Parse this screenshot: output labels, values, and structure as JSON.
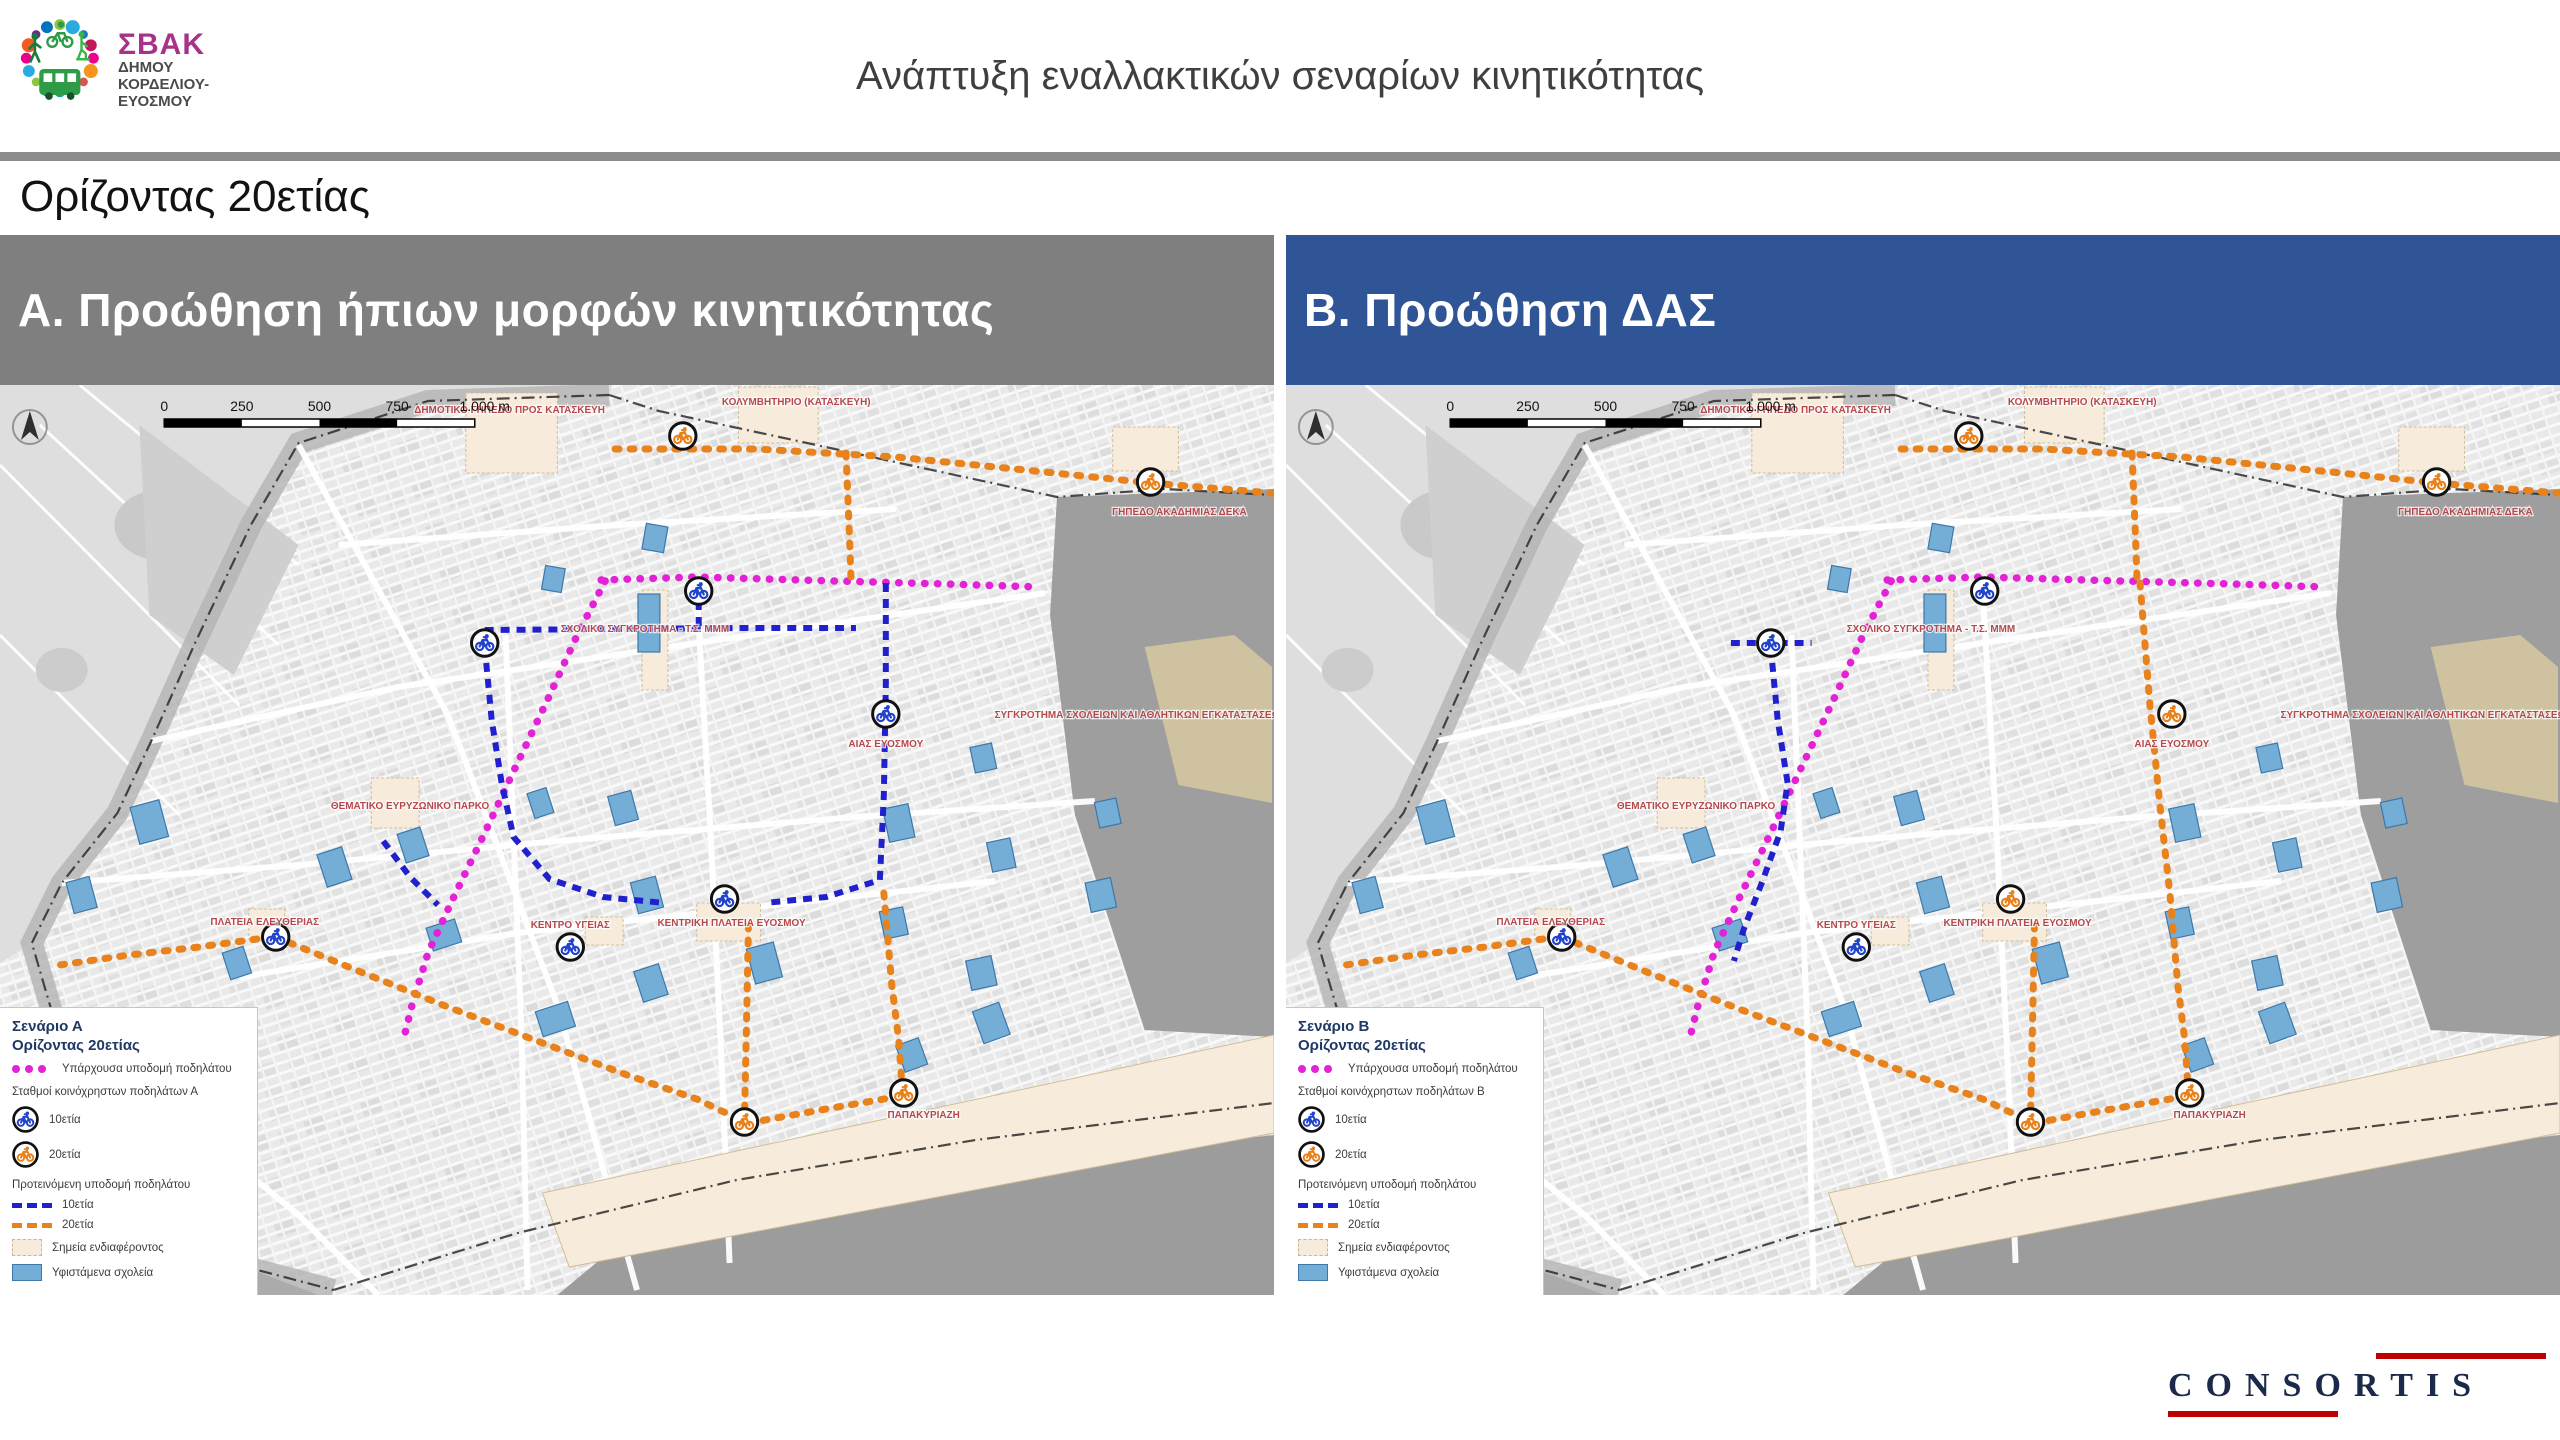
{
  "header": {
    "logo": {
      "abbr": "ΣΒΑΚ",
      "abbr_color": "#a83288",
      "line1": "ΔΗΜΟΥ",
      "line2": "ΚΟΡΔΕΛΙΟΥ-",
      "line3": "ΕΥΟΣΜΟΥ",
      "dot_colors": [
        "#8cc63f",
        "#29abe2",
        "#1b75bc",
        "#c2185b",
        "#ec008c",
        "#f7941d",
        "#d9534f",
        "#39b54a",
        "#00a99d",
        "#9e005d",
        "#8cc63f",
        "#29abe2",
        "#ec008c",
        "#f15a24",
        "#662d91",
        "#0071bc"
      ]
    },
    "title": "Ανάπτυξη εναλλακτικών σεναρίων κινητικότητας"
  },
  "subtitle": "Ορίζοντας 20ετίας",
  "footer": {
    "brand": "CONSORTIS",
    "accent": "#c00000"
  },
  "colors": {
    "panel_a_header": "#7f7f7f",
    "panel_b_header": "#2f5597",
    "existing": "#e322d6",
    "proposed10": "#2020cc",
    "proposed20": "#e8821c",
    "station10": "#2244cc",
    "station20": "#e8821c",
    "map_label": "#b5484d",
    "legend_title": "#1f3864",
    "poi_fill": "#f7ecdc",
    "school_fill": "#74add6",
    "school_stroke": "#3c78aa",
    "map_bg": "#e9e9e9",
    "outside_dark": "#9e9e9e"
  },
  "base_map": {
    "scale_labels": [
      "0",
      "250",
      "500",
      "750",
      "1.000 m"
    ],
    "labels": [
      {
        "t": "ΔΗΜΟΤΙΚΟ ΓΗΠΕΔΟ ΠΡΟΣ ΚΑΤΑΣΚΕΥΗ",
        "x": 512,
        "y": 28
      },
      {
        "t": "ΚΟΛΥΜΒΗΤΗΡΙΟ (ΚΑΤΑΣΚΕΥΗ)",
        "x": 800,
        "y": 20
      },
      {
        "t": "ΓΗΠΕΔΟ ΑΚΑΔΗΜΙΑΣ ΔΕΚΑ",
        "x": 1185,
        "y": 130
      },
      {
        "t": "ΣΧΟΛΙΚΟ ΣΥΓΚΡΟΤΗΜΑ - Τ.Σ. ΜΜΜ",
        "x": 648,
        "y": 247
      },
      {
        "t": "ΣΥΓΚΡΟΤΗΜΑ ΣΧΟΛΕΙΩΝ ΚΑΙ ΑΘΛΗΤΙΚΩΝ ΕΓΚΑΤΑΣΤΑΣΕΩΝ",
        "x": 1146,
        "y": 333
      },
      {
        "t": "ΑΙΑΣ ΕΥΟΣΜΟΥ",
        "x": 890,
        "y": 362
      },
      {
        "t": "ΘΕΜΑΤΙΚΟ ΕΥΡΥΖΩΝΙΚΟ ΠΑΡΚΟ",
        "x": 412,
        "y": 424
      },
      {
        "t": "ΠΛΑΤΕΙΑ ΕΛΕΥΘΕΡΙΑΣ",
        "x": 266,
        "y": 540
      },
      {
        "t": "ΚΕΝΤΡΟ ΥΓΕΙΑΣ",
        "x": 573,
        "y": 543
      },
      {
        "t": "ΚΕΝΤΡΙΚΗ ΠΛΑΤΕΙΑ ΕΥΟΣΜΟΥ",
        "x": 735,
        "y": 541
      },
      {
        "t": "ΠΑΠΑΚΥΡΙΑΖΗ",
        "x": 928,
        "y": 733
      }
    ],
    "pois": [
      [
        468,
        8,
        92,
        80
      ],
      [
        742,
        2,
        80,
        56
      ],
      [
        645,
        205,
        26,
        100
      ],
      [
        700,
        518,
        64,
        38
      ],
      [
        373,
        393,
        48,
        50
      ],
      [
        250,
        524,
        36,
        30
      ],
      [
        588,
        532,
        38,
        28
      ],
      [
        1118,
        42,
        66,
        44
      ]
    ],
    "poi_band": "545,808 1280,650 1280,748 572,882",
    "schools": [
      [
        150,
        437,
        30,
        38,
        -15
      ],
      [
        82,
        510,
        24,
        32,
        -15
      ],
      [
        336,
        482,
        26,
        34,
        -18
      ],
      [
        238,
        578,
        22,
        28,
        -18
      ],
      [
        415,
        460,
        24,
        30,
        -18
      ],
      [
        446,
        550,
        30,
        24,
        -18
      ],
      [
        558,
        634,
        34,
        26,
        -18
      ],
      [
        654,
        598,
        26,
        32,
        -18
      ],
      [
        768,
        578,
        28,
        36,
        -15
      ],
      [
        650,
        510,
        26,
        32,
        -15
      ],
      [
        626,
        423,
        24,
        30,
        -15
      ],
      [
        903,
        438,
        26,
        34,
        -12
      ],
      [
        1006,
        470,
        24,
        30,
        -12
      ],
      [
        1106,
        510,
        26,
        30,
        -12
      ],
      [
        1113,
        428,
        22,
        26,
        -12
      ],
      [
        986,
        588,
        26,
        30,
        -12
      ],
      [
        898,
        538,
        24,
        28,
        -12
      ],
      [
        658,
        153,
        22,
        26,
        10
      ],
      [
        556,
        194,
        20,
        24,
        10
      ],
      [
        988,
        373,
        22,
        26,
        -12
      ],
      [
        543,
        418,
        20,
        26,
        -18
      ],
      [
        996,
        638,
        28,
        34,
        -20
      ],
      [
        916,
        670,
        24,
        28,
        -20
      ],
      [
        652,
        238,
        22,
        58,
        0
      ]
    ],
    "roads": [
      [
        [
          300,
          60
        ],
        [
          450,
          330
        ],
        [
          560,
          620
        ],
        [
          640,
          905
        ]
      ],
      [
        [
          0,
          636
        ],
        [
          140,
          700
        ],
        [
          300,
          830
        ],
        [
          380,
          910
        ]
      ],
      [
        [
          152,
          356
        ],
        [
          400,
          302
        ],
        [
          700,
          258
        ],
        [
          1050,
          208
        ]
      ],
      [
        [
          62,
          498
        ],
        [
          300,
          480
        ],
        [
          560,
          456
        ],
        [
          860,
          432
        ],
        [
          1100,
          416
        ]
      ],
      [
        [
          240,
          592
        ],
        [
          520,
          548
        ],
        [
          760,
          522
        ],
        [
          1000,
          496
        ]
      ],
      [
        [
          508,
          250
        ],
        [
          516,
          450
        ],
        [
          524,
          650
        ],
        [
          530,
          905
        ]
      ],
      [
        [
          700,
          205
        ],
        [
          714,
          450
        ],
        [
          726,
          700
        ],
        [
          733,
          878
        ]
      ],
      [
        [
          340,
          160
        ],
        [
          620,
          140
        ],
        [
          900,
          124
        ]
      ]
    ],
    "fields_region": "0,0 615,0 612,10 430,16 300,58 252,140 196,258 152,356 118,428 62,498 32,558 0,578",
    "field_lines": [
      [
        [
          0,
          80
        ],
        [
          240,
          320
        ]
      ],
      [
        [
          40,
          40
        ],
        [
          280,
          260
        ]
      ],
      [
        [
          0,
          250
        ],
        [
          180,
          430
        ]
      ],
      [
        [
          80,
          0
        ],
        [
          300,
          180
        ]
      ]
    ],
    "dark_regions": [
      {
        "points": "1062,112 1280,104 1280,652 1150,645 1080,430 1055,230",
        "fill": "#9e9e9e"
      },
      {
        "points": "560,910 640,844 900,792 1280,750 1280,910",
        "fill": "#9c9c9c"
      },
      {
        "points": "0,688 120,756 230,876 320,910 0,910",
        "fill": "#ababab"
      },
      {
        "points": "1150,262 1240,250 1278,282 1278,418 1184,400",
        "fill": "#cfc2a0"
      }
    ],
    "boundary_left": [
      [
        612,
        10
      ],
      [
        430,
        16
      ],
      [
        300,
        58
      ],
      [
        252,
        140
      ],
      [
        196,
        258
      ],
      [
        152,
        356
      ],
      [
        118,
        428
      ],
      [
        62,
        498
      ],
      [
        32,
        558
      ],
      [
        56,
        640
      ],
      [
        130,
        758
      ],
      [
        232,
        878
      ],
      [
        335,
        905
      ]
    ],
    "boundary_right": [
      [
        612,
        10
      ],
      [
        662,
        26
      ],
      [
        1062,
        112
      ],
      [
        1170,
        104
      ],
      [
        1278,
        110
      ]
    ],
    "boundary_bottom": [
      [
        335,
        905
      ],
      [
        520,
        848
      ],
      [
        740,
        795
      ],
      [
        980,
        755
      ],
      [
        1280,
        718
      ]
    ],
    "routes_existing": [
      [
        [
          604,
          195
        ],
        [
          700,
          192
        ],
        [
          840,
          196
        ],
        [
          950,
          199
        ],
        [
          1045,
          202
        ]
      ],
      [
        [
          608,
          196
        ],
        [
          580,
          250
        ],
        [
          550,
          315
        ],
        [
          518,
          382
        ],
        [
          486,
          450
        ],
        [
          454,
          516
        ],
        [
          430,
          568
        ],
        [
          414,
          620
        ],
        [
          406,
          652
        ]
      ]
    ]
  },
  "panels": [
    {
      "key": "A",
      "header_label": "Α. Προώθηση ήπιων μορφών κινητικότητας",
      "legend": {
        "title1": "Σενάριο Α",
        "title2": "Ορίζοντας 20ετίας",
        "existing": "Υπάρχουσα υποδομή ποδηλάτου",
        "stations_header": "Σταθμοί κοινόχρηστων ποδηλάτων Α",
        "s10": "10ετία",
        "s20": "20ετία",
        "proposed_header": "Προτεινόμενη υποδομή ποδηλάτου",
        "p10": "10ετία",
        "p20": "20ετία",
        "poi": "Σημεία ενδιαφέροντος",
        "schools": "Υφιστάμενα σχολεία"
      },
      "routes10": [
        [
          [
            487,
            245
          ],
          [
            620,
            244
          ],
          [
            745,
            243
          ],
          [
            860,
            243
          ]
        ],
        [
          [
            890,
            198
          ],
          [
            890,
            300
          ],
          [
            888,
            410
          ],
          [
            884,
            495
          ],
          [
            830,
            512
          ],
          [
            768,
            518
          ]
        ],
        [
          [
            487,
            262
          ],
          [
            494,
            335
          ],
          [
            504,
            398
          ],
          [
            516,
            452
          ],
          [
            552,
            494
          ],
          [
            606,
            512
          ],
          [
            668,
            518
          ]
        ],
        [
          [
            385,
            456
          ],
          [
            412,
            492
          ],
          [
            440,
            520
          ]
        ],
        [
          [
            702,
            200
          ],
          [
            702,
            242
          ]
        ]
      ],
      "routes20": [
        [
          [
            618,
            64
          ],
          [
            760,
            64
          ],
          [
            900,
            72
          ],
          [
            1040,
            86
          ],
          [
            1156,
            98
          ],
          [
            1278,
            108
          ]
        ],
        [
          [
            850,
            68
          ],
          [
            853,
            140
          ],
          [
            855,
            193
          ]
        ],
        [
          [
            888,
            508
          ],
          [
            896,
            600
          ],
          [
            903,
            655
          ],
          [
            906,
            698
          ]
        ],
        [
          [
            752,
            540
          ],
          [
            750,
            640
          ],
          [
            748,
            732
          ]
        ],
        [
          [
            277,
            552
          ],
          [
            360,
            586
          ],
          [
            450,
            622
          ],
          [
            540,
            656
          ],
          [
            630,
            690
          ],
          [
            700,
            714
          ],
          [
            744,
            735
          ]
        ],
        [
          [
            752,
            738
          ],
          [
            830,
            724
          ],
          [
            900,
            712
          ]
        ],
        [
          [
            273,
            552
          ],
          [
            200,
            562
          ],
          [
            130,
            570
          ],
          [
            60,
            580
          ]
        ]
      ],
      "stations10": [
        [
          702,
          206
        ],
        [
          487,
          258
        ],
        [
          890,
          329
        ],
        [
          277,
          552
        ],
        [
          573,
          562
        ],
        [
          728,
          514
        ]
      ],
      "stations20": [
        [
          686,
          51
        ],
        [
          1156,
          97
        ],
        [
          908,
          708
        ],
        [
          748,
          737
        ]
      ]
    },
    {
      "key": "B",
      "header_label": "Β. Προώθηση ΔΑΣ",
      "legend": {
        "title1": "Σενάριο Β",
        "title2": "Ορίζοντας 20ετίας",
        "existing": "Υπάρχουσα υποδομή ποδηλάτου",
        "stations_header": "Σταθμοί κοινόχρηστων ποδηλάτων Β",
        "s10": "10ετία",
        "s20": "20ετία",
        "proposed_header": "Προτεινόμενη υποδομή ποδηλάτου",
        "p10": "10ετία",
        "p20": "20ετία",
        "poi": "Σημεία ενδιαφέροντος",
        "schools": "Υφιστάμενα σχολεία"
      },
      "routes10": [
        [
          [
            447,
            258
          ],
          [
            528,
            258
          ]
        ],
        [
          [
            487,
            262
          ],
          [
            494,
            335
          ],
          [
            504,
            398
          ],
          [
            497,
            446
          ],
          [
            478,
            498
          ],
          [
            460,
            544
          ],
          [
            450,
            576
          ]
        ]
      ],
      "routes20": [
        [
          [
            618,
            64
          ],
          [
            760,
            64
          ],
          [
            900,
            72
          ],
          [
            1040,
            86
          ],
          [
            1156,
            98
          ],
          [
            1278,
            108
          ]
        ],
        [
          [
            850,
            68
          ],
          [
            853,
            140
          ],
          [
            855,
            193
          ]
        ],
        [
          [
            858,
            198
          ],
          [
            868,
            320
          ],
          [
            878,
            420
          ],
          [
            888,
            508
          ],
          [
            896,
            600
          ],
          [
            903,
            655
          ],
          [
            906,
            698
          ]
        ],
        [
          [
            752,
            540
          ],
          [
            750,
            640
          ],
          [
            748,
            732
          ]
        ],
        [
          [
            277,
            552
          ],
          [
            360,
            586
          ],
          [
            450,
            622
          ],
          [
            540,
            656
          ],
          [
            630,
            690
          ],
          [
            700,
            714
          ],
          [
            744,
            735
          ]
        ],
        [
          [
            752,
            738
          ],
          [
            830,
            724
          ],
          [
            900,
            712
          ]
        ],
        [
          [
            273,
            552
          ],
          [
            200,
            562
          ],
          [
            130,
            570
          ],
          [
            60,
            580
          ]
        ]
      ],
      "stations10": [
        [
          702,
          206
        ],
        [
          487,
          258
        ],
        [
          277,
          552
        ],
        [
          573,
          562
        ]
      ],
      "stations20": [
        [
          686,
          51
        ],
        [
          1156,
          97
        ],
        [
          890,
          329
        ],
        [
          908,
          708
        ],
        [
          748,
          737
        ],
        [
          728,
          514
        ]
      ]
    }
  ]
}
